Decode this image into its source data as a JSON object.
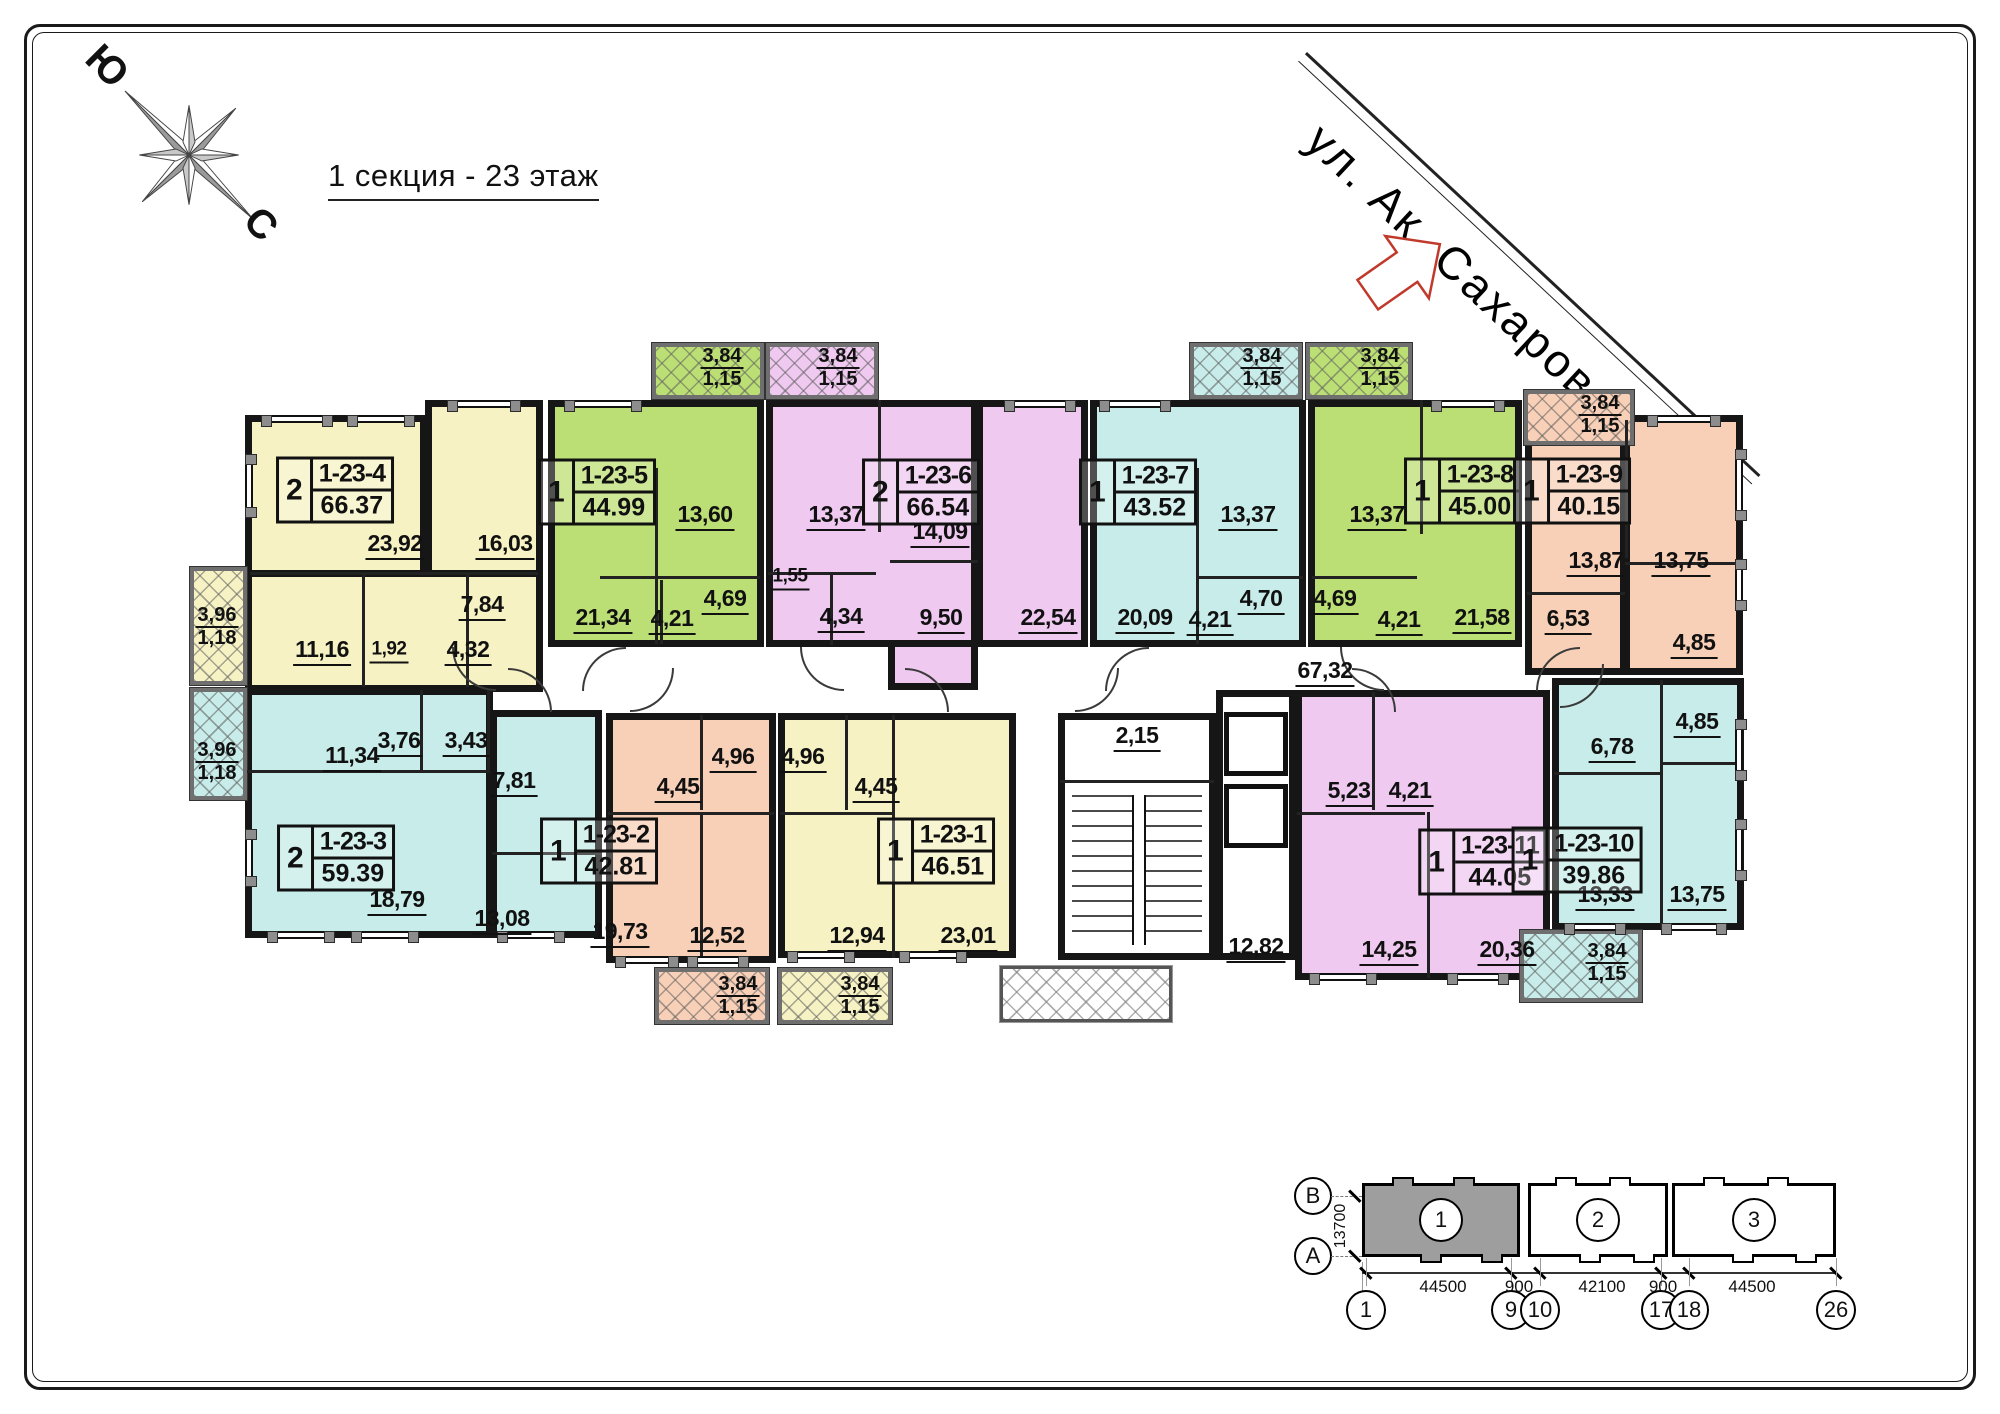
{
  "title": "1 секция - 23 этаж",
  "street": {
    "name": "ул. Ак. Сахарова"
  },
  "compass": {
    "south_label": "Ю",
    "north_label": "С"
  },
  "colors": {
    "yellow": "#F6F2C3",
    "green": "#BCDF75",
    "purple": "#EFC9F0",
    "cyan": "#C7ECE9",
    "salmon": "#F8D0B8",
    "white": "#FFFFFF",
    "wall": "#161616",
    "arrow_red": "#c0392b",
    "keyplan_fill": "#9e9e9e"
  },
  "plan": {
    "rooms": [
      {
        "id": "apt-1-23-4-a",
        "c": "yellow",
        "x": 245,
        "y": 415,
        "w": 182,
        "h": 162
      },
      {
        "id": "apt-1-23-4-b",
        "c": "yellow",
        "x": 425,
        "y": 400,
        "w": 118,
        "h": 177
      },
      {
        "id": "apt-1-23-4-c",
        "c": "yellow",
        "x": 245,
        "y": 570,
        "w": 298,
        "h": 122
      },
      {
        "id": "apt-1-23-5",
        "c": "green",
        "x": 548,
        "y": 400,
        "w": 216,
        "h": 247
      },
      {
        "id": "apt-1-23-6-a",
        "c": "purple",
        "x": 766,
        "y": 400,
        "w": 212,
        "h": 247
      },
      {
        "id": "apt-1-23-6-c",
        "c": "purple",
        "x": 888,
        "y": 640,
        "w": 90,
        "h": 50
      },
      {
        "id": "apt-1-23-6-b",
        "c": "purple",
        "x": 976,
        "y": 400,
        "w": 112,
        "h": 247
      },
      {
        "id": "apt-1-23-7",
        "c": "cyan",
        "x": 1090,
        "y": 400,
        "w": 216,
        "h": 247
      },
      {
        "id": "apt-1-23-8",
        "c": "green",
        "x": 1308,
        "y": 400,
        "w": 214,
        "h": 247
      },
      {
        "id": "apt-1-23-9-a",
        "c": "salmon",
        "x": 1525,
        "y": 415,
        "w": 102,
        "h": 260
      },
      {
        "id": "apt-1-23-9-b",
        "c": "salmon",
        "x": 1623,
        "y": 415,
        "w": 120,
        "h": 260
      },
      {
        "id": "apt-1-23-3-a",
        "c": "cyan",
        "x": 245,
        "y": 688,
        "w": 248,
        "h": 250
      },
      {
        "id": "apt-1-23-3-b",
        "c": "cyan",
        "x": 490,
        "y": 710,
        "w": 112,
        "h": 228
      },
      {
        "id": "apt-1-23-2",
        "c": "salmon",
        "x": 606,
        "y": 713,
        "w": 170,
        "h": 250
      },
      {
        "id": "apt-1-23-1",
        "c": "yellow",
        "x": 778,
        "y": 713,
        "w": 238,
        "h": 245
      },
      {
        "id": "stairwell",
        "c": "white",
        "x": 1058,
        "y": 713,
        "w": 158,
        "h": 247
      },
      {
        "id": "elevator-core",
        "c": "white",
        "x": 1216,
        "y": 690,
        "w": 80,
        "h": 270
      },
      {
        "id": "apt-1-23-11",
        "c": "purple",
        "x": 1295,
        "y": 690,
        "w": 255,
        "h": 290
      },
      {
        "id": "apt-1-23-10",
        "c": "cyan",
        "x": 1552,
        "y": 678,
        "w": 192,
        "h": 252
      }
    ],
    "balconies": [
      {
        "c": "yellow",
        "x": 190,
        "y": 567,
        "w": 57,
        "h": 118
      },
      {
        "c": "cyan",
        "x": 190,
        "y": 688,
        "w": 57,
        "h": 112
      },
      {
        "c": "green",
        "x": 652,
        "y": 343,
        "w": 112,
        "h": 56
      },
      {
        "c": "purple",
        "x": 766,
        "y": 343,
        "w": 112,
        "h": 56
      },
      {
        "c": "cyan",
        "x": 1190,
        "y": 343,
        "w": 112,
        "h": 56
      },
      {
        "c": "green",
        "x": 1306,
        "y": 343,
        "w": 106,
        "h": 56
      },
      {
        "c": "salmon",
        "x": 1524,
        "y": 390,
        "w": 110,
        "h": 55
      },
      {
        "c": "salmon",
        "x": 655,
        "y": 968,
        "w": 114,
        "h": 56
      },
      {
        "c": "yellow",
        "x": 778,
        "y": 968,
        "w": 114,
        "h": 56
      },
      {
        "c": "cyan",
        "x": 1520,
        "y": 930,
        "w": 122,
        "h": 72
      }
    ],
    "entrance_balcony": {
      "x": 1000,
      "y": 966,
      "w": 172,
      "h": 56
    },
    "partitions": [
      [
        250,
        572,
        288,
        3
      ],
      [
        362,
        575,
        3,
        112
      ],
      [
        466,
        575,
        3,
        112
      ],
      [
        655,
        468,
        3,
        176
      ],
      [
        600,
        576,
        160,
        3
      ],
      [
        660,
        580,
        3,
        64
      ],
      [
        878,
        400,
        3,
        132
      ],
      [
        768,
        572,
        108,
        3
      ],
      [
        830,
        575,
        3,
        70
      ],
      [
        890,
        560,
        88,
        3
      ],
      [
        1196,
        468,
        3,
        176
      ],
      [
        1198,
        576,
        105,
        3
      ],
      [
        1420,
        400,
        3,
        134
      ],
      [
        1312,
        576,
        105,
        3
      ],
      [
        1625,
        420,
        3,
        138
      ],
      [
        1625,
        562,
        118,
        3
      ],
      [
        1527,
        592,
        98,
        3
      ],
      [
        247,
        770,
        243,
        3
      ],
      [
        420,
        690,
        3,
        80
      ],
      [
        487,
        690,
        3,
        80
      ],
      [
        492,
        852,
        110,
        3
      ],
      [
        608,
        812,
        166,
        3
      ],
      [
        700,
        715,
        3,
        95
      ],
      [
        700,
        815,
        3,
        148
      ],
      [
        892,
        715,
        3,
        243
      ],
      [
        780,
        812,
        112,
        3
      ],
      [
        845,
        715,
        3,
        95
      ],
      [
        1060,
        780,
        154,
        3
      ],
      [
        1297,
        812,
        128,
        3
      ],
      [
        1372,
        692,
        3,
        118
      ],
      [
        1427,
        812,
        3,
        166
      ],
      [
        1660,
        680,
        3,
        248
      ],
      [
        1554,
        772,
        106,
        3
      ],
      [
        1662,
        762,
        80,
        3
      ]
    ],
    "windows": [
      [
        262,
        415,
        70,
        8
      ],
      [
        348,
        415,
        66,
        8
      ],
      [
        448,
        400,
        72,
        8
      ],
      [
        565,
        400,
        76,
        8
      ],
      [
        1005,
        400,
        70,
        8
      ],
      [
        1100,
        400,
        70,
        8
      ],
      [
        1432,
        400,
        72,
        8
      ],
      [
        1648,
        415,
        72,
        8
      ],
      [
        268,
        931,
        66,
        8
      ],
      [
        352,
        931,
        66,
        8
      ],
      [
        498,
        931,
        66,
        8
      ],
      [
        616,
        956,
        62,
        8
      ],
      [
        688,
        956,
        60,
        8
      ],
      [
        788,
        951,
        66,
        8
      ],
      [
        900,
        951,
        66,
        8
      ],
      [
        1310,
        973,
        66,
        8
      ],
      [
        1448,
        973,
        60,
        8
      ],
      [
        1565,
        923,
        60,
        8
      ],
      [
        1662,
        923,
        64,
        8
      ],
      [
        245,
        455,
        8,
        62
      ],
      [
        245,
        830,
        8,
        56
      ],
      [
        1735,
        450,
        8,
        70
      ],
      [
        1735,
        560,
        8,
        50
      ],
      [
        1735,
        720,
        8,
        60
      ],
      [
        1735,
        820,
        8,
        60
      ]
    ],
    "doors": [
      [
        452,
        647,
        44,
        0
      ],
      [
        582,
        647,
        44,
        90
      ],
      [
        800,
        647,
        44,
        0
      ],
      [
        1105,
        647,
        44,
        90
      ],
      [
        1340,
        647,
        44,
        0
      ],
      [
        1536,
        647,
        44,
        90
      ],
      [
        508,
        668,
        44,
        180
      ],
      [
        630,
        668,
        44,
        270
      ],
      [
        905,
        668,
        44,
        180
      ],
      [
        1075,
        668,
        44,
        270
      ],
      [
        1352,
        668,
        44,
        180
      ],
      [
        1560,
        664,
        44,
        270
      ]
    ],
    "stairs": {
      "x": 1072,
      "y": 795,
      "w": 130,
      "h": 150
    },
    "elevators": [
      [
        1224,
        712,
        64,
        64
      ],
      [
        1224,
        784,
        64,
        64
      ]
    ],
    "apartments": [
      {
        "cnt": "2",
        "num": "1-23-4",
        "area": "66.37",
        "x": 335,
        "y": 490
      },
      {
        "cnt": "1",
        "num": "1-23-5",
        "area": "44.99",
        "x": 597,
        "y": 492
      },
      {
        "cnt": "2",
        "num": "1-23-6",
        "area": "66.54",
        "x": 921,
        "y": 492
      },
      {
        "cnt": "1",
        "num": "1-23-7",
        "area": "43.52",
        "x": 1138,
        "y": 492
      },
      {
        "cnt": "1",
        "num": "1-23-8",
        "area": "45.00",
        "x": 1463,
        "y": 491
      },
      {
        "cnt": "1",
        "num": "1-23-9",
        "area": "40.15",
        "x": 1572,
        "y": 491
      },
      {
        "cnt": "2",
        "num": "1-23-3",
        "area": "59.39",
        "x": 336,
        "y": 858
      },
      {
        "cnt": "1",
        "num": "1-23-2",
        "area": "42.81",
        "x": 599,
        "y": 851
      },
      {
        "cnt": "1",
        "num": "1-23-1",
        "area": "46.51",
        "x": 936,
        "y": 851
      },
      {
        "cnt": "1",
        "num": "1-23-11",
        "area": "44.05",
        "x": 1483,
        "y": 862
      },
      {
        "cnt": "1",
        "num": "1-23-10",
        "area": "39.86",
        "x": 1577,
        "y": 860
      }
    ],
    "area_labels": [
      {
        "t": "23,92",
        "x": 395,
        "y": 545
      },
      {
        "t": "16,03",
        "x": 505,
        "y": 545
      },
      {
        "t": "7,84",
        "x": 482,
        "y": 606
      },
      {
        "t": "11,16",
        "x": 322,
        "y": 651
      },
      {
        "t": "1,92",
        "x": 389,
        "y": 651,
        "s": 1
      },
      {
        "t": "4,32",
        "x": 468,
        "y": 651
      },
      {
        "t": "13,60",
        "x": 705,
        "y": 516
      },
      {
        "t": "21,34",
        "x": 603,
        "y": 619
      },
      {
        "t": "4,21",
        "x": 672,
        "y": 620
      },
      {
        "t": "4,69",
        "x": 725,
        "y": 600
      },
      {
        "t": "13,37",
        "x": 836,
        "y": 516
      },
      {
        "t": "14,09",
        "x": 940,
        "y": 533
      },
      {
        "t": "1,55",
        "x": 790,
        "y": 578,
        "s": 1
      },
      {
        "t": "4,34",
        "x": 841,
        "y": 618
      },
      {
        "t": "9,50",
        "x": 941,
        "y": 619
      },
      {
        "t": "22,54",
        "x": 1048,
        "y": 619
      },
      {
        "t": "13,37",
        "x": 1248,
        "y": 516
      },
      {
        "t": "20,09",
        "x": 1145,
        "y": 619
      },
      {
        "t": "4,21",
        "x": 1210,
        "y": 621
      },
      {
        "t": "4,70",
        "x": 1261,
        "y": 600
      },
      {
        "t": "13,37",
        "x": 1377,
        "y": 516
      },
      {
        "t": "4,69",
        "x": 1335,
        "y": 600
      },
      {
        "t": "4,21",
        "x": 1399,
        "y": 621
      },
      {
        "t": "21,58",
        "x": 1482,
        "y": 619
      },
      {
        "t": "13,87",
        "x": 1596,
        "y": 562
      },
      {
        "t": "13,75",
        "x": 1681,
        "y": 562
      },
      {
        "t": "6,53",
        "x": 1568,
        "y": 620
      },
      {
        "t": "4,85",
        "x": 1694,
        "y": 644
      },
      {
        "t": "11,34",
        "x": 352,
        "y": 757
      },
      {
        "t": "3,76",
        "x": 399,
        "y": 742
      },
      {
        "t": "3,43",
        "x": 466,
        "y": 742
      },
      {
        "t": "18,79",
        "x": 397,
        "y": 901
      },
      {
        "t": "7,81",
        "x": 514,
        "y": 782
      },
      {
        "t": "13,08",
        "x": 502,
        "y": 920
      },
      {
        "t": "4,45",
        "x": 678,
        "y": 788
      },
      {
        "t": "4,96",
        "x": 733,
        "y": 758
      },
      {
        "t": "19,73",
        "x": 620,
        "y": 933
      },
      {
        "t": "12,52",
        "x": 717,
        "y": 937
      },
      {
        "t": "4,96",
        "x": 803,
        "y": 758
      },
      {
        "t": "4,45",
        "x": 876,
        "y": 788
      },
      {
        "t": "12,94",
        "x": 857,
        "y": 937
      },
      {
        "t": "23,01",
        "x": 968,
        "y": 937
      },
      {
        "t": "5,23",
        "x": 1349,
        "y": 792
      },
      {
        "t": "4,21",
        "x": 1410,
        "y": 792
      },
      {
        "t": "14,25",
        "x": 1389,
        "y": 951
      },
      {
        "t": "20,36",
        "x": 1507,
        "y": 951
      },
      {
        "t": "6,78",
        "x": 1612,
        "y": 748
      },
      {
        "t": "4,85",
        "x": 1697,
        "y": 723
      },
      {
        "t": "13,33",
        "x": 1605,
        "y": 896
      },
      {
        "t": "13,75",
        "x": 1697,
        "y": 896
      },
      {
        "t": "67,32",
        "x": 1325,
        "y": 672
      },
      {
        "t": "2,15",
        "x": 1137,
        "y": 737
      },
      {
        "t": "12,82",
        "x": 1256,
        "y": 948
      }
    ],
    "balcony_labels": [
      {
        "a": "3,96",
        "b": "1,18",
        "x": 217,
        "y": 627
      },
      {
        "a": "3,96",
        "b": "1,18",
        "x": 217,
        "y": 762
      },
      {
        "a": "3,84",
        "b": "1,15",
        "x": 722,
        "y": 368
      },
      {
        "a": "3,84",
        "b": "1,15",
        "x": 838,
        "y": 368
      },
      {
        "a": "3,84",
        "b": "1,15",
        "x": 1262,
        "y": 368
      },
      {
        "a": "3,84",
        "b": "1,15",
        "x": 1380,
        "y": 368
      },
      {
        "a": "3,84",
        "b": "1,15",
        "x": 1600,
        "y": 415
      },
      {
        "a": "3,84",
        "b": "1,15",
        "x": 738,
        "y": 996
      },
      {
        "a": "3,84",
        "b": "1,15",
        "x": 860,
        "y": 996
      },
      {
        "a": "3,84",
        "b": "1,15",
        "x": 1607,
        "y": 963
      }
    ]
  },
  "keyplan": {
    "axes": [
      {
        "label": "В",
        "x": 1313,
        "y": 1196
      },
      {
        "label": "А",
        "x": 1313,
        "y": 1256
      }
    ],
    "vertical_dim": "13700",
    "sections": [
      {
        "num": "1",
        "x": 1362,
        "y": 1183,
        "w": 158,
        "h": 74,
        "filled": true
      },
      {
        "num": "2",
        "x": 1528,
        "y": 1183,
        "w": 140,
        "h": 74,
        "filled": false
      },
      {
        "num": "3",
        "x": 1672,
        "y": 1183,
        "w": 164,
        "h": 74,
        "filled": false
      }
    ],
    "dim_labels": [
      {
        "t": "44500",
        "x": 1443
      },
      {
        "t": "900",
        "x": 1519
      },
      {
        "t": "42100",
        "x": 1602
      },
      {
        "t": "900",
        "x": 1663
      },
      {
        "t": "44500",
        "x": 1752
      }
    ],
    "bubbles": [
      {
        "t": "1",
        "x": 1366
      },
      {
        "t": "9",
        "x": 1511
      },
      {
        "t": "10",
        "x": 1540
      },
      {
        "t": "17",
        "x": 1661
      },
      {
        "t": "18",
        "x": 1689
      },
      {
        "t": "26",
        "x": 1836
      }
    ]
  }
}
